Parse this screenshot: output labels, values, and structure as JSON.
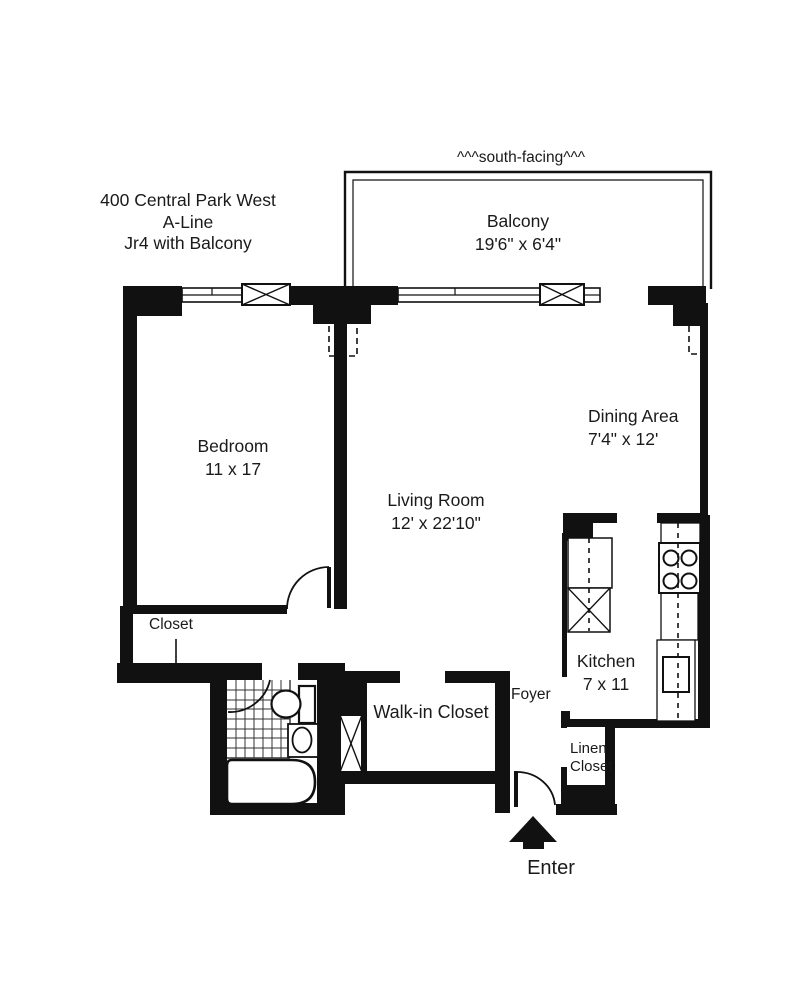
{
  "title": {
    "line1": "400 Central Park West",
    "line2": "A-Line",
    "line3": "Jr4 with Balcony"
  },
  "orientation_note": "^^^south-facing^^^",
  "rooms": [
    {
      "id": "balcony",
      "name": "Balcony",
      "dimensions": "19'6\" x 6'4\""
    },
    {
      "id": "bedroom",
      "name": "Bedroom",
      "dimensions": "11 x 17"
    },
    {
      "id": "living_room",
      "name": "Living Room",
      "dimensions": "12' x 22'10\""
    },
    {
      "id": "dining_area",
      "name": "Dining Area",
      "dimensions": "7'4\" x 12'"
    },
    {
      "id": "kitchen",
      "name": "Kitchen",
      "dimensions": "7 x 11"
    },
    {
      "id": "closet",
      "name": "Closet",
      "dimensions": ""
    },
    {
      "id": "walk_in_closet",
      "name": "Walk-in Closet",
      "dimensions": ""
    },
    {
      "id": "foyer",
      "name": "Foyer",
      "dimensions": ""
    },
    {
      "id": "linen_closet",
      "name_line1": "Linen",
      "name_line2": "Closet",
      "dimensions": ""
    }
  ],
  "entry": {
    "label": "Enter"
  },
  "colors": {
    "wall": "#111111",
    "background": "#ffffff",
    "text": "#1a1a1a"
  }
}
